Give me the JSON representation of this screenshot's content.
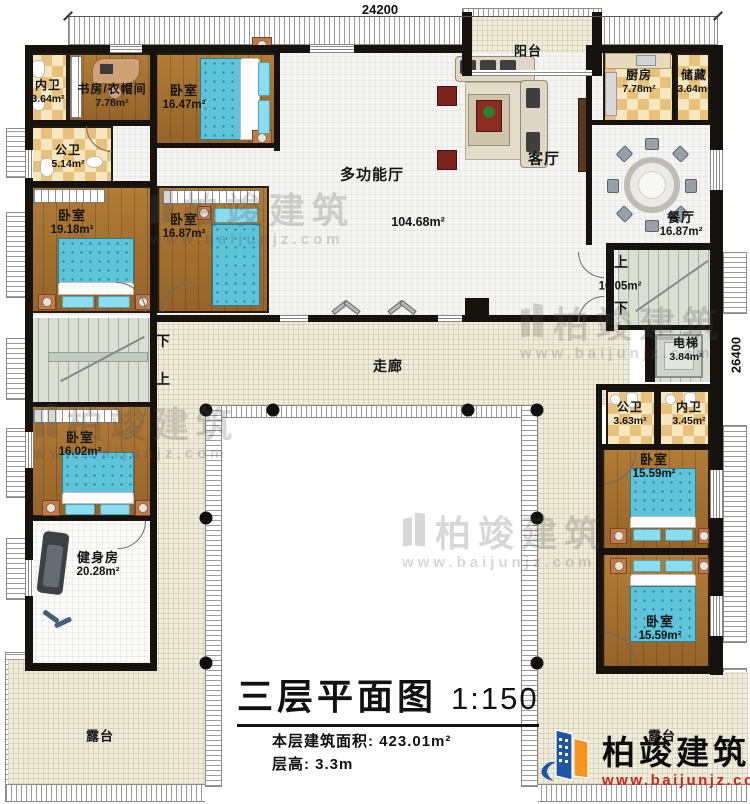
{
  "title": {
    "main": "三层平面图",
    "scale": "1:150"
  },
  "info": {
    "area_label": "本层建筑面积:",
    "area_value": "423.01m²",
    "height_label": "层高:",
    "height_value": "3.3m"
  },
  "dimensions": {
    "top": "24200",
    "right": "26400"
  },
  "corridor_label": "走廊",
  "stairs": {
    "up": "上",
    "down": "下",
    "right_area": "10.05m²"
  },
  "rooms": {
    "neiwei_tl": {
      "name": "内卫",
      "area": "3.64m²"
    },
    "study": {
      "name": "书房/衣帽间",
      "area": "7.78m²"
    },
    "bed_1647": {
      "name": "卧室",
      "area": "16.47m²"
    },
    "balcony": {
      "name": "阳台"
    },
    "kitchen": {
      "name": "厨房",
      "area": "7.78m²"
    },
    "storage": {
      "name": "储藏",
      "area": "3.64m²"
    },
    "hall": {
      "name": "多功能厅",
      "area": "104.68m²"
    },
    "living": {
      "name": "客厅"
    },
    "dining": {
      "name": "餐厅",
      "area": "16.87m²"
    },
    "gongwei_left": {
      "name": "公卫",
      "area": "5.14m²"
    },
    "bed_1918": {
      "name": "卧室",
      "area": "19.18m²"
    },
    "bed_1687": {
      "name": "卧室",
      "area": "16.87m²"
    },
    "elevator": {
      "name": "电梯",
      "area": "3.84m²"
    },
    "gongwei_right": {
      "name": "公卫",
      "area": "3.63m²"
    },
    "neiwei_right": {
      "name": "内卫",
      "area": "3.45m²"
    },
    "bed_1559a": {
      "name": "卧室",
      "area": "15.59m²"
    },
    "bed_1559b": {
      "name": "卧室",
      "area": "15.59m²"
    },
    "bed_1602": {
      "name": "卧室",
      "area": "16.02m²"
    },
    "gym": {
      "name": "健身房",
      "area": "20.28m²"
    },
    "terrace_left": {
      "name": "露台"
    },
    "terrace_right": {
      "name": "露台"
    }
  },
  "watermark": {
    "brand": "柏竣建筑",
    "url": "www.baijunjz.com"
  },
  "logo": {
    "brand": "柏竣建筑",
    "url": "www.baijunjz.com"
  },
  "colors": {
    "wood": "#a6732e",
    "tile_light": "#f6e7c0",
    "tile_dark": "#e8c27b",
    "corridor": "#efecda",
    "stair": "#d9dfd3",
    "bed_blue": "#5ec4da",
    "wall": "#16130f",
    "logo_blue": "#1c56a8",
    "logo_orange": "#f7941d",
    "logo_red": "#c9261d"
  }
}
